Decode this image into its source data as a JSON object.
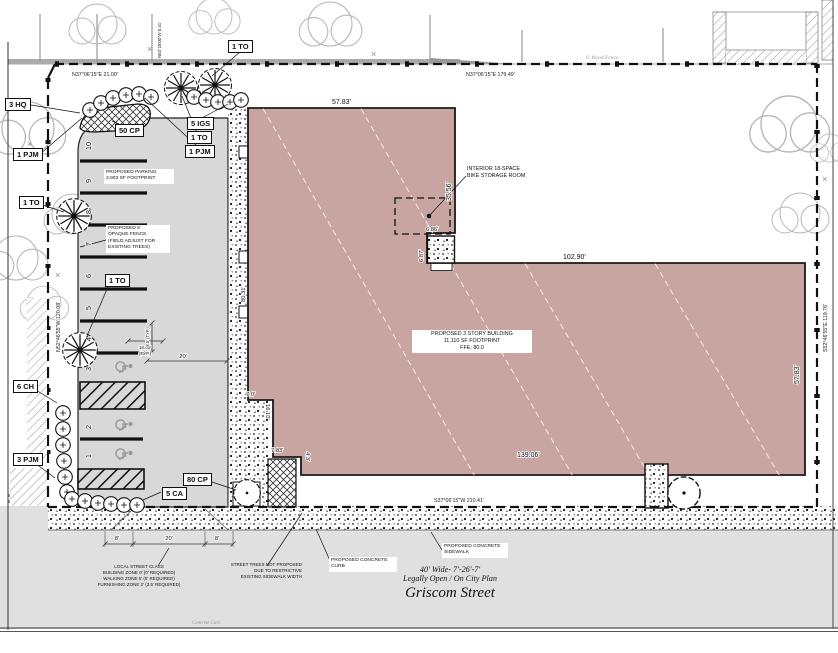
{
  "colors": {
    "building_fill": "#c8a5a0",
    "parking_fill": "#d8d8d8",
    "street_fill": "#e0e0e0"
  },
  "plant_labels": [
    "1 TO",
    "3 HQ",
    "50 CP",
    "5 IGS",
    "1 TO",
    "1 PJM",
    "1 PJM",
    "1 TO",
    "1 TO",
    "6 CH",
    "3 PJM",
    "80 CP",
    "5 CA"
  ],
  "stalls": [
    "10",
    "9",
    "8",
    "7",
    "6",
    "5",
    "4",
    "3",
    "2",
    "1"
  ],
  "bearings": {
    "top_left": "N37°06'15\"E   21.00'",
    "top_right": "N37°06'15\"E   179.49'",
    "bottom": "S37°06'15\"W   210.41'",
    "right": "S52°46'55\"E   119.76'",
    "left": "N52°46'55\"W   120.08'",
    "top_corner": "N63°18'00\"W  0.41'"
  },
  "dims": {
    "bldg_top": "57.83'",
    "bldg_upper_right": "35.56'",
    "bldg_wing_top": "102.90'",
    "bldg_wing_right": "57.83'",
    "bldg_bottom": "139.06'",
    "lot_east": "80.31'",
    "notch_w": "6.86'",
    "notch_h": "6.87'",
    "step1_w": "7.0'",
    "step1_h": "16.10'",
    "step2_w": "7.83'",
    "step2_h": "4.3'",
    "stall_depth": "18.00'",
    "stall_typ": "(TYP.)",
    "stall_width": "8.5' (TYP.)",
    "aisle": "20'",
    "curb_left": "8'",
    "curb_mid": "20'",
    "curb_right": "8'"
  },
  "notes": {
    "parking": [
      "PROPOSED PARKING",
      "3,903 SF FOOTPRINT"
    ],
    "fence": [
      "PROPOSED 5'",
      "OPAQUE FENCE",
      "(FIELD ADJUST FOR",
      "EXISTING TREES)"
    ],
    "building": [
      "PROPOSED 3 STORY BUILDING",
      "11,110 SF FOOTPRINT",
      "FFE: 80.0"
    ],
    "bike": [
      "INTERIOR 18-SPACE",
      "BIKE STORAGE ROOM"
    ],
    "curb": [
      "PROPOSED CONCRETE",
      "CURB"
    ],
    "sidewalk": [
      "PROPOSED CONCRETE",
      "SIDEWALK"
    ],
    "street_class": [
      "LOCAL STREET CLASS",
      "BUILDING ZONE 0' (0' REQUIRED)",
      "WALKING ZONE 5' (5' REQUIRED)",
      "FURNISHING ZONE 2' (3.5' REQUIRED)"
    ],
    "street_trees": [
      "STREET TREES NOT PROPOSED",
      "DUE TO RESTRICTIVE",
      "EXISTING SIDEWALK WIDTH"
    ],
    "wood_fence": "6' Wood Fence",
    "existing_curb": "Concrete Curb"
  },
  "street": {
    "width": "40' Wide- 7'-26'-7'",
    "status": "Legally Open / On City Plan",
    "name": "Griscom Street"
  }
}
